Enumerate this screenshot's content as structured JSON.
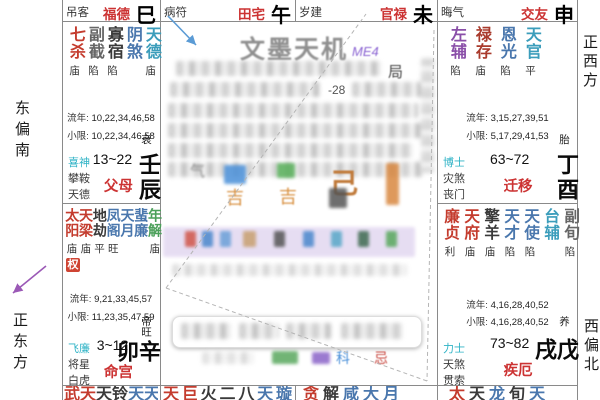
{
  "app": {
    "watermark": "文墨天机",
    "watermark_code": "ME4"
  },
  "palette": {
    "red": "#c43c2e",
    "darkred": "#a93a2c",
    "blue": "#4a77ad",
    "teal": "#3b9dbb",
    "green": "#4ba05a",
    "purple": "#8a4fa8",
    "cyan": "#2fb3c6",
    "black": "#3a3a3a",
    "gray": "#666666",
    "accent": "#cc3333",
    "hua_badge_bg": "#cf4433",
    "arrow_blue": "#5b9bd5",
    "arrow_purple": "#9b59b6"
  },
  "compass": {
    "left_top": "东偏南",
    "left_bottom": "正东方",
    "right_top": "正西方",
    "right_bottom": "西偏北"
  },
  "labels": {
    "liunian": "流年:",
    "xiaoxian": "小限:"
  },
  "top_strip": [
    {
      "god": "吊客",
      "palace": "福德",
      "branch": "巳",
      "pos": "c1"
    },
    {
      "god": "病符",
      "palace": "田宅",
      "branch": "午",
      "pos": "c2"
    },
    {
      "god": "岁建",
      "palace": "官禄",
      "branch": "未",
      "pos": "c3"
    },
    {
      "god": "晦气",
      "palace": "交友",
      "branch": "申",
      "pos": "c4"
    }
  ],
  "palaces": {
    "chen": {
      "stars": [
        {
          "name": "七杀",
          "color": "red",
          "bright": "庙"
        },
        {
          "name": "副截",
          "color": "gray",
          "bright": "陷"
        },
        {
          "name": "寡宿",
          "color": "black",
          "bright": "陷"
        },
        {
          "name": "阴煞",
          "color": "blue",
          "bright": ""
        },
        {
          "name": "天德",
          "color": "teal",
          "bright": "庙"
        }
      ],
      "liunian": "10,22,34,46,58",
      "xiaoxian": "10,22,34,46,58",
      "gods": [
        {
          "name": "喜神",
          "color": "cyan"
        },
        {
          "name": "攀鞍",
          "color": "black"
        },
        {
          "name": "天德",
          "color": "black"
        }
      ],
      "age": "13~22",
      "palace": "父母",
      "stage": "衰",
      "pillar": "壬辰"
    },
    "mao": {
      "stars": [
        {
          "name": "太阳",
          "color": "red",
          "bright": "庙"
        },
        {
          "name": "天梁",
          "color": "red",
          "bright": "庙"
        },
        {
          "name": "地劫",
          "color": "black",
          "bright": "平"
        },
        {
          "name": "凤阁",
          "color": "blue",
          "bright": "旺"
        },
        {
          "name": "天月",
          "color": "blue",
          "bright": ""
        },
        {
          "name": "蜚廉",
          "color": "blue",
          "bright": ""
        },
        {
          "name": "年解",
          "color": "green",
          "bright": "庙"
        }
      ],
      "hua": "权",
      "liunian": "9,21,33,45,57",
      "xiaoxian": "11,23,35,47,59",
      "gods": [
        {
          "name": "飞廉",
          "color": "cyan"
        },
        {
          "name": "将星",
          "color": "black"
        },
        {
          "name": "白虎",
          "color": "black"
        }
      ],
      "age": "3~12",
      "palace": "命宫",
      "stage": "帝旺",
      "pillar": "辛卯"
    },
    "you": {
      "stars": [
        {
          "name": "左辅",
          "color": "purple",
          "bright": "陷"
        },
        {
          "name": "禄存",
          "color": "darkred",
          "bright": "庙"
        },
        {
          "name": "恩光",
          "color": "blue",
          "bright": "陷"
        },
        {
          "name": "天官",
          "color": "teal",
          "bright": "平"
        }
      ],
      "liunian": "3,15,27,39,51",
      "xiaoxian": "5,17,29,41,53",
      "gods": [
        {
          "name": "博士",
          "color": "cyan"
        },
        {
          "name": "灾煞",
          "color": "black"
        },
        {
          "name": "丧门",
          "color": "black"
        }
      ],
      "age": "63~72",
      "palace": "迁移",
      "stage": "胎",
      "pillar": "丁酉"
    },
    "xu": {
      "stars": [
        {
          "name": "廉贞",
          "color": "red",
          "bright": "利"
        },
        {
          "name": "天府",
          "color": "red",
          "bright": "庙"
        },
        {
          "name": "擎羊",
          "color": "black",
          "bright": "庙"
        },
        {
          "name": "天才",
          "color": "blue",
          "bright": "陷"
        },
        {
          "name": "天使",
          "color": "blue",
          "bright": "陷"
        },
        {
          "name": "台辅",
          "color": "teal",
          "bright": ""
        },
        {
          "name": "副旬",
          "color": "gray",
          "bright": "陷"
        }
      ],
      "liunian": "4,16,28,40,52",
      "xiaoxian": "4,16,28,40,52",
      "gods": [
        {
          "name": "力士",
          "color": "cyan"
        },
        {
          "name": "天煞",
          "color": "black"
        },
        {
          "name": "贯索",
          "color": "black"
        }
      ],
      "age": "73~82",
      "palace": "疾厄",
      "stage": "养",
      "pillar": "戊戌"
    }
  },
  "bottom_strip": {
    "yin": {
      "chars": [
        {
          "c": "武",
          "color": "red"
        },
        {
          "c": "天",
          "color": "red"
        },
        {
          "c": "天",
          "color": "black"
        },
        {
          "c": "铃",
          "color": "black"
        },
        {
          "c": "天",
          "color": "blue"
        },
        {
          "c": "天",
          "color": "blue"
        },
        {
          "c": "龙",
          "color": "blue"
        }
      ]
    },
    "chou": {
      "chars": [
        {
          "c": "天",
          "color": "red"
        },
        {
          "c": "巨",
          "color": "red"
        },
        {
          "c": "火",
          "color": "black"
        },
        {
          "c": "二",
          "color": "black"
        },
        {
          "c": "八",
          "color": "black"
        },
        {
          "c": "天",
          "color": "blue"
        },
        {
          "c": "璇",
          "color": "blue"
        }
      ]
    },
    "zi": {
      "chars": [
        {
          "c": "贪",
          "color": "red"
        },
        {
          "c": "解",
          "color": "black"
        },
        {
          "c": "咸",
          "color": "blue"
        },
        {
          "c": "大",
          "color": "blue"
        },
        {
          "c": "月",
          "color": "blue"
        }
      ]
    },
    "hai": {
      "chars": [
        {
          "c": "太",
          "color": "red"
        },
        {
          "c": "天",
          "color": "black"
        },
        {
          "c": "龙",
          "color": "blue"
        },
        {
          "c": "旬",
          "color": "black"
        },
        {
          "c": "天",
          "color": "blue"
        }
      ]
    }
  },
  "center": {
    "ju": "局",
    "value": "-28",
    "qi": "气",
    "stem": "己",
    "ji1": "吉",
    "ji2": "吉",
    "ke": "科",
    "ji": "忌"
  }
}
